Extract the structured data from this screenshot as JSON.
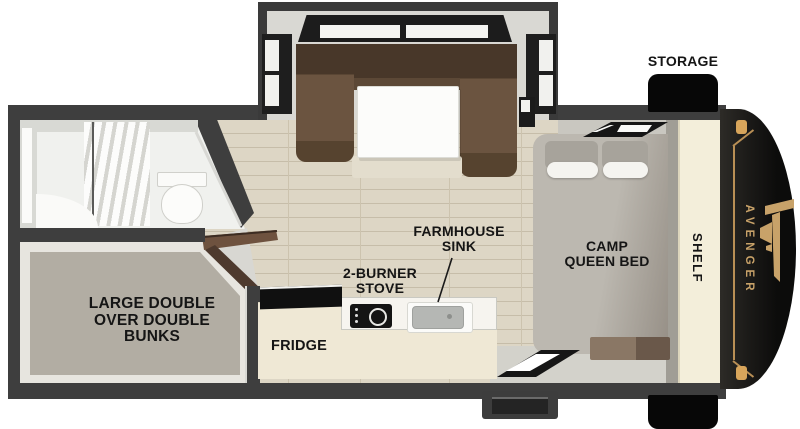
{
  "labels": {
    "storage": "STORAGE",
    "farmhouse_sink": [
      "FARMHOUSE",
      "SINK"
    ],
    "burner_stove": [
      "2-BURNER",
      "STOVE"
    ],
    "fridge": "FRIDGE",
    "camp_queen_bed": [
      "CAMP",
      "QUEEN BED"
    ],
    "bunks": [
      "LARGE DOUBLE",
      "OVER DOUBLE",
      "BUNKS"
    ],
    "shelf": "SHELF",
    "brand": "AVENGER"
  },
  "colors": {
    "label_text": "#151515",
    "accent_gold": "#c8a269",
    "wall_dark": "#3e3e3e",
    "front_cap_black": "#0c0c0b",
    "floor_wood": "#ddd6c5",
    "counter_cream": "#efe8d5",
    "dinette_brown": "#5c4836",
    "bed_gray": "#b3afa7",
    "bunk_taupe": "#b2ada3"
  }
}
